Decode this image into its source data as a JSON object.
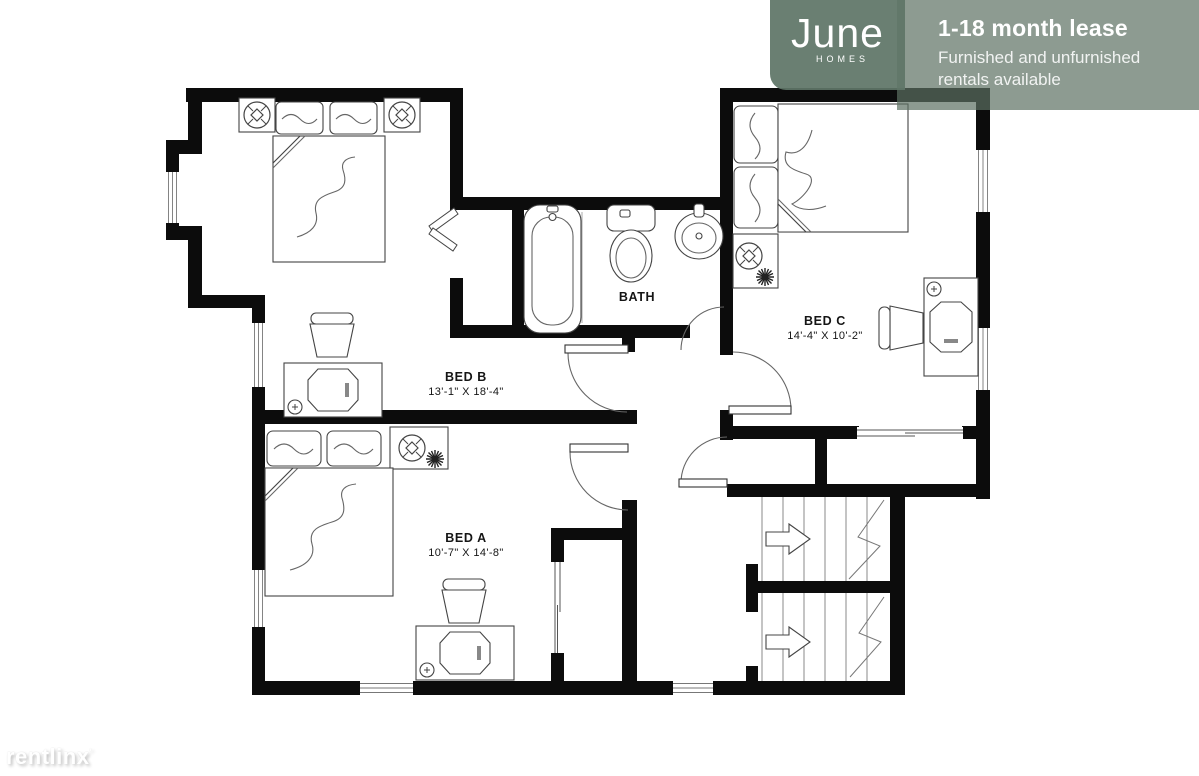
{
  "banner": {
    "logo_text": "June",
    "logo_subtext": "HOMES",
    "headline": "1-18 month lease",
    "subheadline": "Furnished and unfurnished rentals available",
    "logo_box_color": "#6a7f72",
    "info_box_color": "#8fa296"
  },
  "rooms": {
    "bed_a": {
      "name": "BED A",
      "dimensions": "10'-7\" X 14'-8\""
    },
    "bed_b": {
      "name": "BED B",
      "dimensions": "13'-1\" X 18'-4\""
    },
    "bed_c": {
      "name": "BED C",
      "dimensions": "14'-4\" X 10'-2\""
    },
    "bath": {
      "name": "BATH"
    }
  },
  "watermark": {
    "text": "rentlinx",
    "mark": "'"
  },
  "plan": {
    "wall_color": "#0c0c0c",
    "line_color": "#555555",
    "symbols": [
      "double-bed",
      "pillow",
      "blanket-fold",
      "nightstand",
      "table-lamp",
      "plant",
      "desk",
      "computer",
      "desk-chair",
      "bathtub",
      "toilet",
      "sink",
      "door-swing",
      "bifold-closet-door",
      "sliding-door",
      "window",
      "stairs-up-arrow",
      "stair-break-line"
    ]
  }
}
